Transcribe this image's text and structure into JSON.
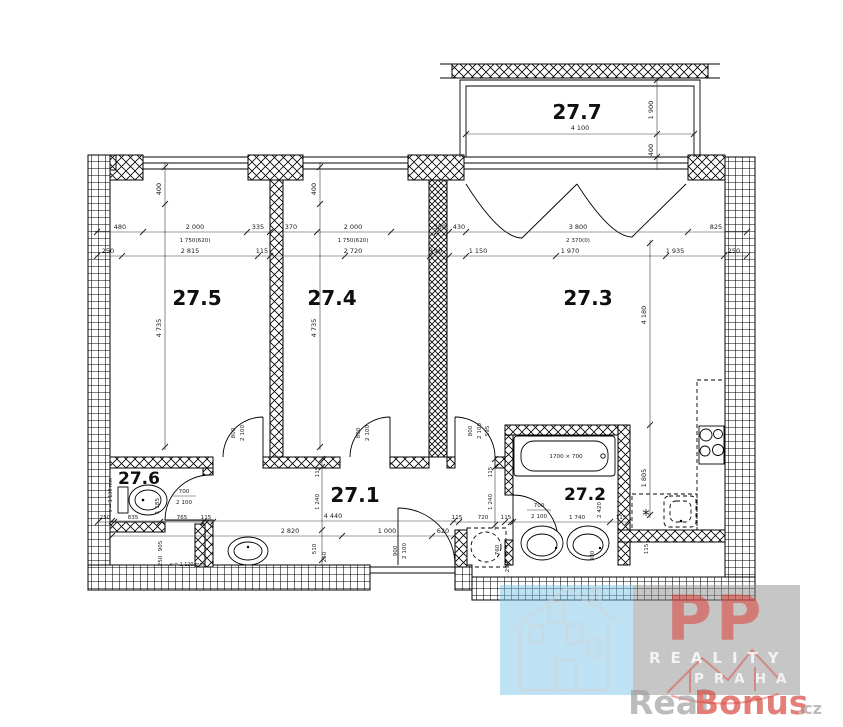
{
  "plan": {
    "rooms": {
      "r1": "27.1",
      "r2": "27.2",
      "r3": "27.3",
      "r4": "27.4",
      "r5": "27.5",
      "r6": "27.6",
      "r7": "27.7"
    },
    "fixtures": {
      "tub": "1700 × 700",
      "wc_h": "v = 1 130 mm",
      "basin_h": "v = 1 120 mm",
      "star": "*"
    },
    "dims": {
      "a1": "480",
      "a2": "2 000",
      "a3": "335",
      "a4": "370",
      "a5": "2 000",
      "a6": "350",
      "a7": "430",
      "a8": "3 800",
      "a9": "825",
      "sub1": "1 750(620)",
      "sub2": "1 750(620)",
      "sub3": "2 370(0)",
      "b1": "250",
      "b2": "2 815",
      "b3": "115",
      "b4": "2 720",
      "b5": "190",
      "b6": "1 150",
      "b7": "1 970",
      "b8": "1 935",
      "b9": "250",
      "v400a": "400",
      "v400b": "400",
      "v4735a": "4 735",
      "v4735b": "4 735",
      "v4180": "4 180",
      "bal_w": "4 100",
      "bal_d": "1 900",
      "bal_off": "400",
      "hall_w": "4 440",
      "h2820": "2 820",
      "h1000": "1 000",
      "h620": "620",
      "h115a": "115",
      "h720": "720",
      "h115b": "115",
      "v115a": "115",
      "v1240a": "1 240",
      "v115b": "115",
      "v1240b": "1 240",
      "v510": "510",
      "v250": "250",
      "d800a": "800",
      "d2100a": "2 100",
      "d800b": "800",
      "d2100b": "2 100",
      "d800c": "800",
      "d2100c": "2 100",
      "d595": "595",
      "e900": "900",
      "e2100": "2 100",
      "wm760": "760",
      "wm290": "290",
      "wc700": "700",
      "wc2100": "2 100",
      "wc1185": "1 185",
      "wc250a": "250",
      "wc835": "835",
      "wc765": "765",
      "wc115": "115",
      "wc905": "905",
      "wc250b": "250",
      "bt700": "700",
      "bt2100": "2 100",
      "bt1740": "1 740",
      "bt2420": "2 420",
      "bt115": "115",
      "bt300": "300",
      "k1805": "1 805",
      "k115b": "115"
    }
  },
  "watermark": {
    "pp": "PP",
    "reality": "REALITY",
    "praha": "PRAHA",
    "real": "Real",
    "bonus": "Bonus",
    "cz": ".cz",
    "colors": {
      "blue": "#7ec5e9",
      "gray": "#8e8e8e",
      "red": "#e0352b",
      "text_gray": "#a0a0a0",
      "bonus_red": "#d5493f"
    }
  }
}
